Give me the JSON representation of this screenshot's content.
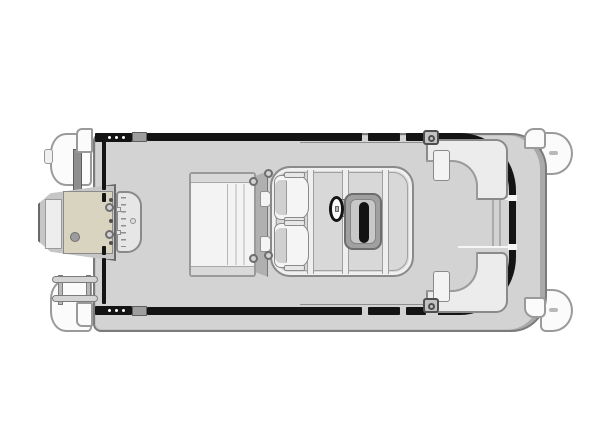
{
  "diagram": {
    "title": "Pontoon boat floor plan - top view",
    "type": "boat-floorplan",
    "text_labels": [],
    "colors": {
      "background": "#ffffff",
      "deck": "#d3d3d3",
      "deck_edge": "#7b7b7b",
      "fence": "#141414",
      "tube": "#fbfbfb",
      "module": "#d8d8d8",
      "upholstery_border": "#8a8a8a",
      "console": "#a0a0a0",
      "console_screen": "#131313",
      "motor_panel": "#d9d4c0",
      "hardware": "#b0b0b0"
    },
    "parts": {
      "deck": {
        "label": "Main deck"
      },
      "fence": {
        "label": "Fence rail"
      },
      "outboard_motor": {
        "label": "Outboard motor"
      },
      "swim_ladder": {
        "label": "Swim ladder"
      },
      "stern_tube_port": {
        "label": "Pontoon tube stern end (port)"
      },
      "stern_tube_starboard": {
        "label": "Pontoon tube stern end (starboard)"
      },
      "bow_nose_port": {
        "label": "Pontoon tube bow nose (port)"
      },
      "bow_nose_starboard": {
        "label": "Pontoon tube bow nose (starboard)"
      },
      "aft_bench": {
        "label": "Aft bench lounge"
      },
      "pedestal_platform": {
        "label": "Seat pedestal platform"
      },
      "captain_chair_port": {
        "label": "Captain chair (port)"
      },
      "captain_chair_starboard": {
        "label": "Captain chair (starboard)"
      },
      "helm_module": {
        "label": "Helm platform module"
      },
      "helm_console": {
        "label": "Helm console"
      },
      "steering_wheel": {
        "label": "Steering wheel"
      },
      "bow_lounge_port": {
        "label": "Bow L-lounge (port)"
      },
      "bow_lounge_starboard": {
        "label": "Bow L-lounge (starboard)"
      },
      "bow_gate": {
        "label": "Bow boarding gate"
      },
      "stern_gate": {
        "label": "Stern boarding gate"
      },
      "cleat": {
        "label": "Mooring cleat"
      },
      "transom_bracket": {
        "label": "Transom bracket"
      },
      "corner_bumper": {
        "label": "Corner bumper"
      }
    }
  }
}
